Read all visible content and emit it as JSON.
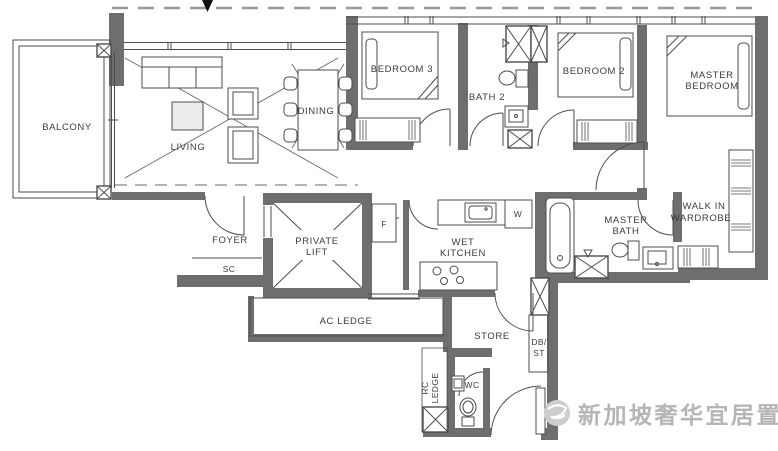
{
  "colors": {
    "wall": "#6e6e6e",
    "line": "#4d4d4d",
    "dashed": "#9a9a9a",
    "text": "#3c3c3c",
    "watermark": "#b5b5b5"
  },
  "labels": {
    "balcony": "BALCONY",
    "living": "LIVING",
    "dining": "DINING",
    "bedroom3": "BEDROOM 3",
    "bath2": "BATH 2",
    "bedroom2": "BEDROOM 2",
    "master_bedroom": {
      "line1": "MASTER",
      "line2": "BEDROOM"
    },
    "walk_in_wardrobe": {
      "line1": "WALK IN",
      "line2": "WARDROBE"
    },
    "master_bath": {
      "line1": "MASTER",
      "line2": "BATH"
    },
    "wet_kitchen": {
      "line1": "WET",
      "line2": "KITCHEN"
    },
    "private_lift": {
      "line1": "PRIVATE",
      "line2": "LIFT"
    },
    "foyer": "FOYER",
    "sc": "SC",
    "f": "F",
    "w": "W",
    "ac_ledge": "AC LEDGE",
    "store": "STORE",
    "db_st": {
      "line1": "DB/",
      "line2": "ST"
    },
    "rc_ledge": {
      "line1": "RC",
      "line2": "LEDGE"
    },
    "wc": "WC"
  },
  "watermark": {
    "text": "新加坡奢华宜居置业",
    "logo": "globe-logo-icon"
  }
}
